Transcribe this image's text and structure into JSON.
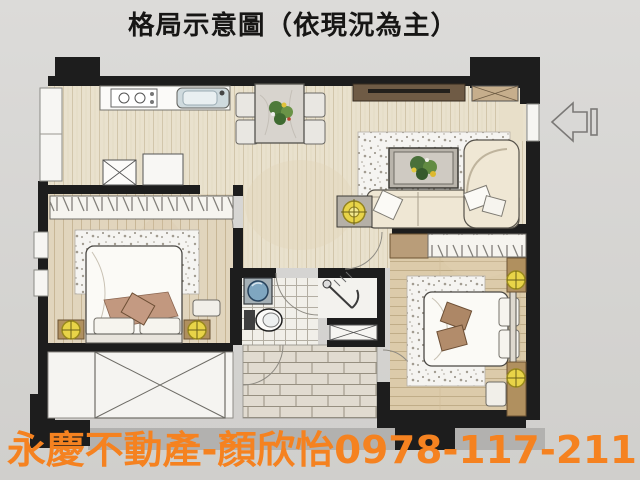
{
  "title": "格局示意圖（依現況為主）",
  "watermark": {
    "text": "永慶不動產-顏欣怡0978-117-211",
    "agency": "永慶不動產",
    "agent": "顏欣怡",
    "phone": "0978-117-211",
    "color": "#f58220"
  },
  "colors": {
    "background": "#d8d6d3",
    "wall": "#1d1d1d",
    "wood_floor": "#e9e1cd",
    "bedroom_left_floor": "#e1d5bd",
    "bedroom_right_floor": "#dccbaa",
    "carpet": "#f5f4f1",
    "lamp_yellow": "#e8d448",
    "sink_blue": "#7fa6c0",
    "shadow_strip": "#b2b1af"
  },
  "floorplan": {
    "rooms": [
      "kitchen",
      "dining-area",
      "living-room",
      "bedroom-left",
      "bedroom-right",
      "bathroom",
      "shower-room",
      "hallway",
      "balcony",
      "entry"
    ],
    "entrance_arrow_direction": "left"
  }
}
